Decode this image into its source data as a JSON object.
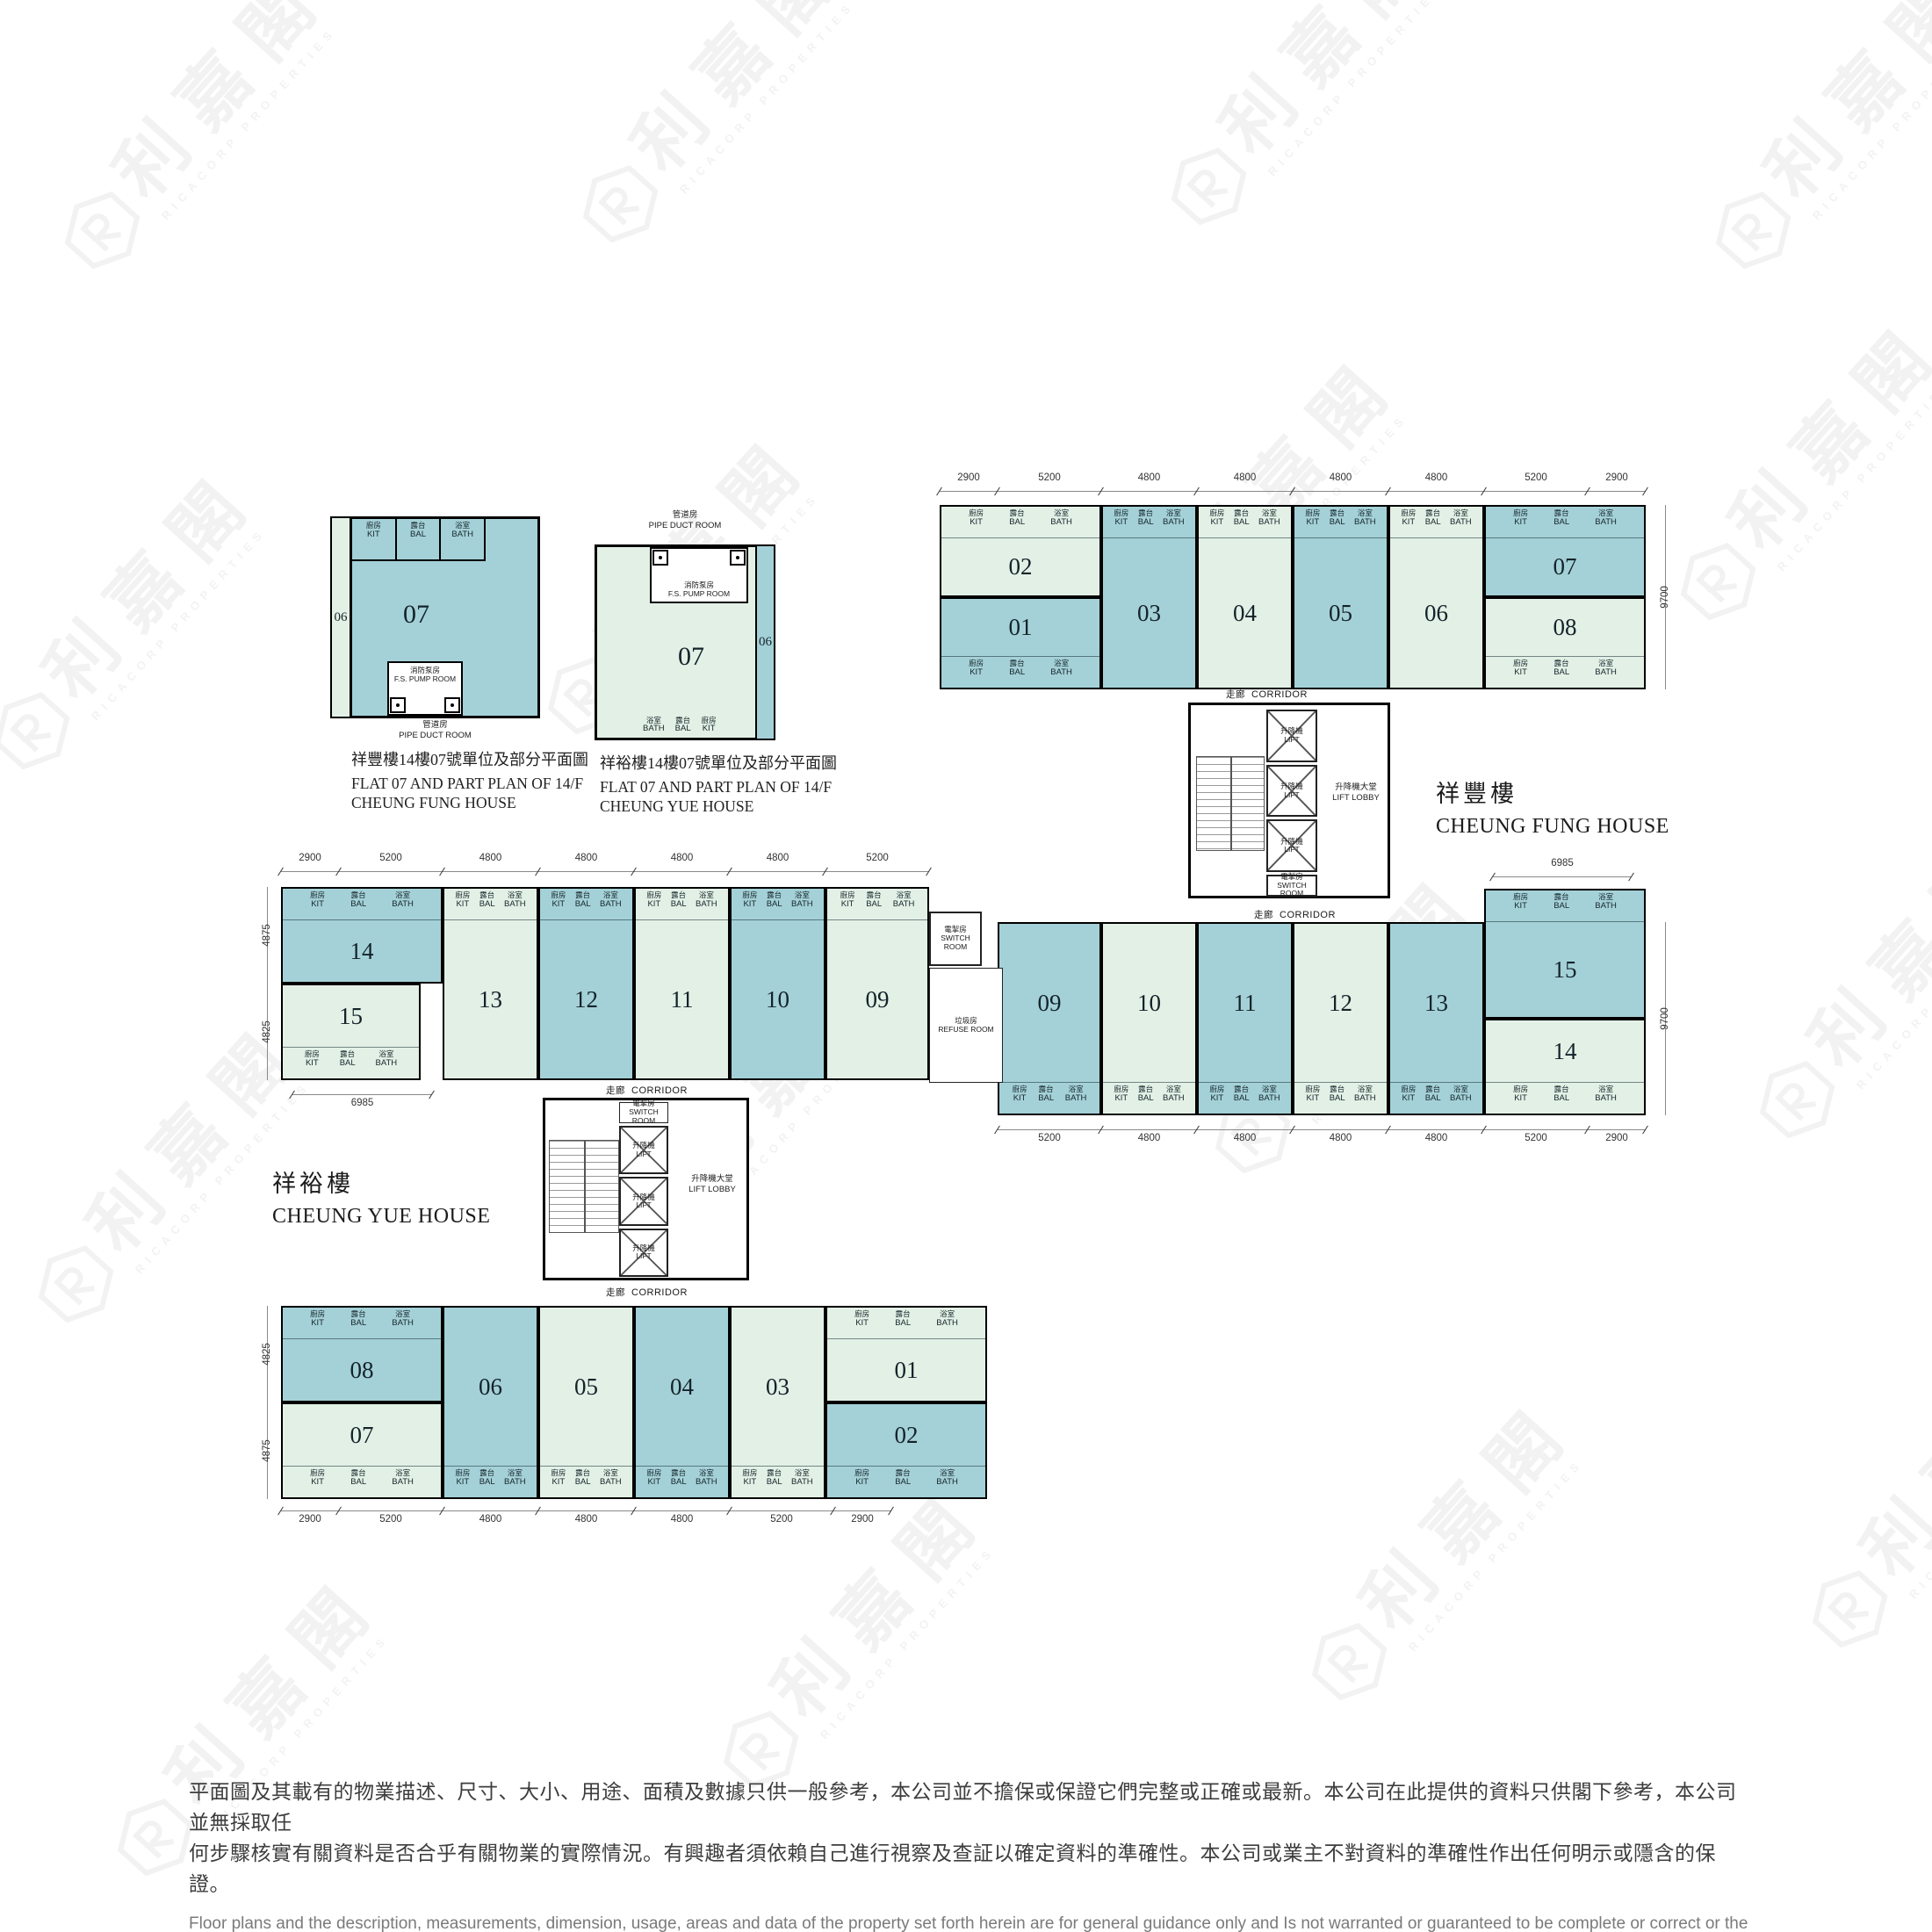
{
  "watermark": {
    "cjk": "利嘉閣",
    "latin": "RICACORP PROPERTIES"
  },
  "colors": {
    "unit_teal": "#a4d1d7",
    "unit_green": "#e3f0e6",
    "wall": "#000000"
  },
  "room_labels": {
    "kit": {
      "zh": "廚房",
      "en": "KIT"
    },
    "bal": {
      "zh": "露台",
      "en": "BAL"
    },
    "bath": {
      "zh": "浴室",
      "en": "BATH"
    }
  },
  "common": {
    "corridor": {
      "zh": "走廊",
      "en": "CORRIDOR"
    },
    "lift": {
      "zh": "升降機",
      "en": "LIFT"
    },
    "lift_lobby": {
      "zh": "升降機大堂",
      "en": "LIFT LOBBY"
    },
    "switch_room": {
      "zh": "電掣房",
      "en": "SWITCH ROOM"
    },
    "refuse_room": {
      "zh": "垃圾房",
      "en": "REFUSE ROOM"
    },
    "fs_pump_room": {
      "zh": "消防泵房",
      "en": "F.S. PUMP ROOM"
    },
    "pipe_duct_room": {
      "zh": "管道房",
      "en": "PIPE DUCT ROOM"
    }
  },
  "partial_plans": [
    {
      "unit": "07",
      "neighbor": "06",
      "caption_zh": "祥豐樓14樓07號單位及部分平面圖",
      "caption_en_1": "FLAT 07 AND PART PLAN OF 14/F",
      "caption_en_2": "CHEUNG FUNG HOUSE"
    },
    {
      "unit": "07",
      "neighbor": "06",
      "caption_zh": "祥裕樓14樓07號單位及部分平面圖",
      "caption_en_1": "FLAT 07 AND PART PLAN OF 14/F",
      "caption_en_2": "CHEUNG YUE HOUSE"
    }
  ],
  "buildings": [
    {
      "id": "cheung_fung",
      "name_zh": "祥豐樓",
      "name_en": "CHEUNG FUNG HOUSE",
      "rows": [
        {
          "dims_top": [
            "2900",
            "5200",
            "4800",
            "4800",
            "4800",
            "4800",
            "5200",
            "2900"
          ],
          "dim_right": "9700",
          "cells": [
            {
              "stack": [
                {
                  "no": "02",
                  "tone": "green"
                },
                {
                  "no": "01",
                  "tone": "teal"
                }
              ]
            },
            {
              "no": "03",
              "tone": "teal"
            },
            {
              "no": "04",
              "tone": "green"
            },
            {
              "no": "05",
              "tone": "teal"
            },
            {
              "no": "06",
              "tone": "green"
            },
            {
              "stack": [
                {
                  "no": "07",
                  "tone": "teal"
                },
                {
                  "no": "08",
                  "tone": "green"
                }
              ]
            }
          ]
        },
        {
          "dims_bottom": [
            "5200",
            "4800",
            "4800",
            "4800",
            "4800",
            "5200",
            "2900"
          ],
          "dim_top_right": "6985",
          "dim_right": "9700",
          "cells": [
            {
              "no": "09",
              "tone": "teal"
            },
            {
              "no": "10",
              "tone": "green"
            },
            {
              "no": "11",
              "tone": "teal"
            },
            {
              "no": "12",
              "tone": "green"
            },
            {
              "no": "13",
              "tone": "teal"
            },
            {
              "stack": [
                {
                  "no": "15",
                  "tone": "teal"
                },
                {
                  "no": "14",
                  "tone": "green"
                }
              ]
            }
          ]
        }
      ]
    },
    {
      "id": "cheung_yue",
      "name_zh": "祥裕樓",
      "name_en": "CHEUNG YUE HOUSE",
      "rows": [
        {
          "dims_top": [
            "2900",
            "5200",
            "4800",
            "4800",
            "4800",
            "4800",
            "5200"
          ],
          "dims_left": [
            "4875",
            "4825"
          ],
          "dim_bottom_left": "6985",
          "cells": [
            {
              "stack": [
                {
                  "no": "14",
                  "tone": "teal"
                },
                {
                  "no": "15",
                  "tone": "green"
                }
              ]
            },
            {
              "no": "13",
              "tone": "green"
            },
            {
              "no": "12",
              "tone": "teal"
            },
            {
              "no": "11",
              "tone": "green"
            },
            {
              "no": "10",
              "tone": "teal"
            },
            {
              "no": "09",
              "tone": "green"
            }
          ]
        },
        {
          "dims_bottom": [
            "2900",
            "5200",
            "4800",
            "4800",
            "4800",
            "5200",
            "2900"
          ],
          "dims_left": [
            "4825",
            "4875"
          ],
          "cells": [
            {
              "stack": [
                {
                  "no": "08",
                  "tone": "teal"
                },
                {
                  "no": "07",
                  "tone": "green"
                }
              ]
            },
            {
              "no": "06",
              "tone": "teal"
            },
            {
              "no": "05",
              "tone": "green"
            },
            {
              "no": "04",
              "tone": "teal"
            },
            {
              "no": "03",
              "tone": "green"
            },
            {
              "stack": [
                {
                  "no": "01",
                  "tone": "green"
                },
                {
                  "no": "02",
                  "tone": "teal"
                }
              ]
            }
          ]
        }
      ]
    }
  ],
  "disclaimer": {
    "zh": [
      "平面圖及其載有的物業描述、尺寸、大小、用途、面積及數據只供一般參考，本公司並不擔保或保證它們完整或正確或最新。本公司在此提供的資料只供閣下參考，本公司並無採取任",
      "何步驟核實有關資料是否合乎有關物業的實際情況。有興趣者須依賴自己進行視察及查証以確定資料的準確性。本公司或業主不對資料的準確性作出任何明示或隱含的保證。"
    ],
    "en": [
      "Floor plans and the description, measurements, dimension, usage, areas and data of the property set forth herein are for general guidance only and Is not warranted or guaranteed to be complete or correct or the",
      "latest. Interested parties should rely on their own inspection and verification and should satisfy themselves as to the accuracy of the particulars contained herein which are provided by us for information only.  Our",
      "Company has not taken any step to verify whether the information reflects the actual status of the property.  No warranty for accuracy is given or implied by the owners or us."
    ]
  }
}
